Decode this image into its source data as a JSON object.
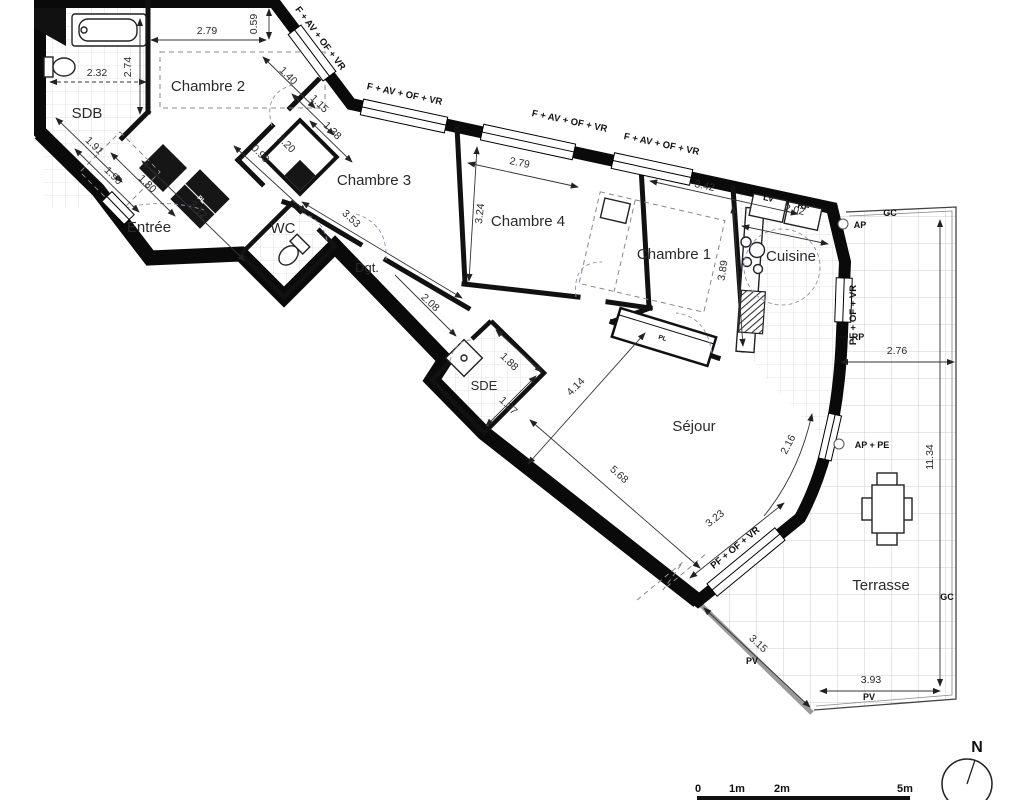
{
  "plan": {
    "rooms": [
      {
        "name": "SDB"
      },
      {
        "name": "Chambre 2"
      },
      {
        "name": "Entrée"
      },
      {
        "name": "WC"
      },
      {
        "name": "Chambre 3"
      },
      {
        "name": "Dgt."
      },
      {
        "name": "Chambre 4"
      },
      {
        "name": "Chambre 1"
      },
      {
        "name": "Cuisine"
      },
      {
        "name": "SDE"
      },
      {
        "name": "Séjour"
      },
      {
        "name": "Terrasse"
      }
    ],
    "dims": [
      {
        "v": "2.79"
      },
      {
        "v": "0.59"
      },
      {
        "v": "2.32"
      },
      {
        "v": "2.74"
      },
      {
        "v": "1.91"
      },
      {
        "v": "1.90"
      },
      {
        "v": "1.80"
      },
      {
        "v": "3.12"
      },
      {
        "v": "1.40"
      },
      {
        "v": "1.15"
      },
      {
        "v": "1.38"
      },
      {
        "v": "0.90"
      },
      {
        "v": "1.20"
      },
      {
        "v": "3.53"
      },
      {
        "v": "2.08"
      },
      {
        "v": "3.24"
      },
      {
        "v": "2.79"
      },
      {
        "v": "3.42"
      },
      {
        "v": "2.02"
      },
      {
        "v": "3.89"
      },
      {
        "v": "1.88"
      },
      {
        "v": "1.37"
      },
      {
        "v": "4.14"
      },
      {
        "v": "5.68"
      },
      {
        "v": "2.16"
      },
      {
        "v": "3.23"
      },
      {
        "v": "2.76"
      },
      {
        "v": "11.34"
      },
      {
        "v": "3.15"
      },
      {
        "v": "3.93"
      }
    ],
    "openings": [
      {
        "label": "F + AV + OF + VR"
      },
      {
        "label": "F + AV + OF + VR"
      },
      {
        "label": "F + AV + OF + VR"
      },
      {
        "label": "F + AV + OF + VR"
      },
      {
        "label": "PF + OF + VR"
      },
      {
        "label": "PF + OF + VR"
      }
    ],
    "tech": [
      {
        "label": "AP"
      },
      {
        "label": "GC"
      },
      {
        "label": "RP"
      },
      {
        "label": "AP + PE"
      },
      {
        "label": "GC"
      },
      {
        "label": "PV"
      },
      {
        "label": "PV"
      },
      {
        "label": "LV"
      },
      {
        "label": "RF"
      },
      {
        "label": "PL"
      },
      {
        "label": "PL"
      }
    ],
    "scale_bar": {
      "labels": [
        {
          "t": "0"
        },
        {
          "t": "1m"
        },
        {
          "t": "2m"
        },
        {
          "t": "5m"
        }
      ]
    },
    "compass": {
      "label": "N"
    }
  }
}
